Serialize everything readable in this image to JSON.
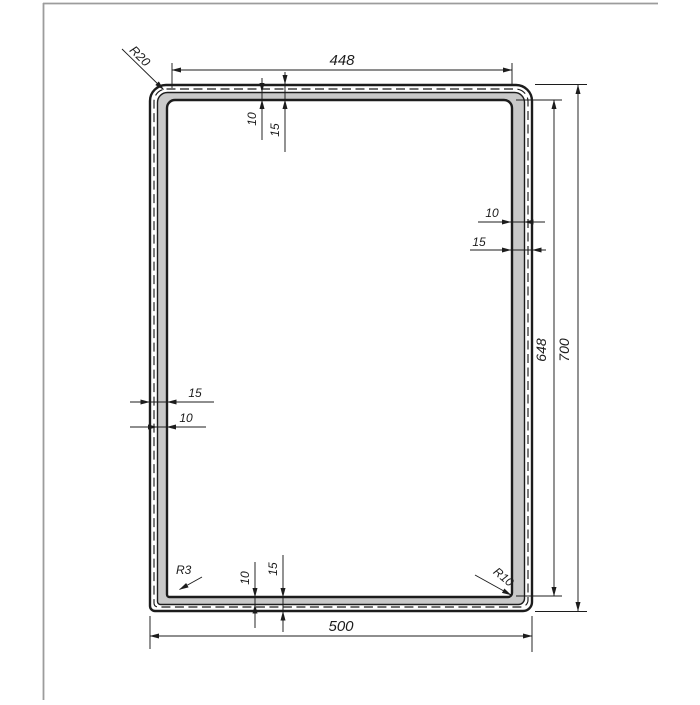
{
  "drawing": {
    "dims": {
      "top_width": "448",
      "bottom_width": "500",
      "outer_height": "700",
      "inner_height": "648",
      "wall_thickness": "15",
      "wall_inner_thickness": "10",
      "corner_radius_top_left": "R20",
      "corner_radius_bottom_left": "R3",
      "corner_radius_bottom_right": "R10"
    },
    "colors": {
      "line": "#1c1c1c",
      "fill": "#c9c9c9",
      "sheet_border": "#9c9c9c",
      "background": "#ffffff"
    }
  }
}
